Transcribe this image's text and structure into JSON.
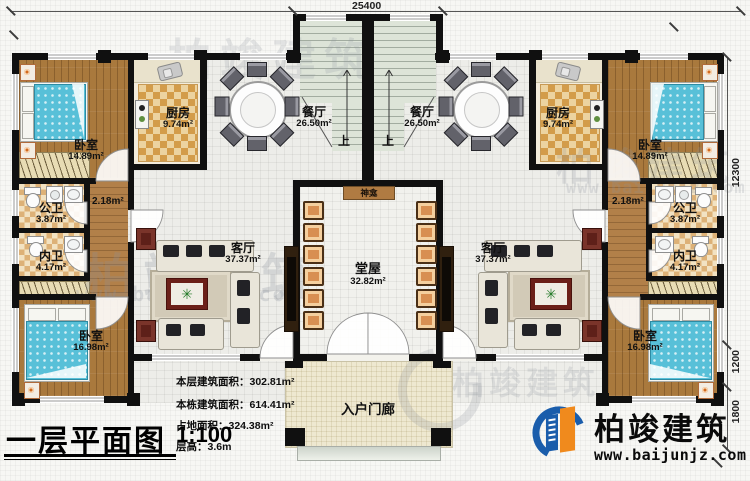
{
  "dimensions": {
    "top": "25400",
    "right_main": "12300",
    "right_mid": "1200",
    "right_low": "1800"
  },
  "rooms": {
    "bedroom_top": {
      "name": "卧室",
      "area": "14.89m²"
    },
    "kitchen": {
      "name": "厨房",
      "area": "9.74m²"
    },
    "dining": {
      "name": "餐厅",
      "area": "26.50m²"
    },
    "bath_public": {
      "name": "公卫",
      "area": "3.87m²"
    },
    "bath_private": {
      "name": "内卫",
      "area": "4.17m²"
    },
    "living": {
      "name": "客厅",
      "area": "37.37m²"
    },
    "bedroom_bottom": {
      "name": "卧室",
      "area": "16.98m²"
    },
    "hall": {
      "name": "堂屋",
      "area": "32.82m²"
    },
    "shrine": {
      "name": "神龛"
    },
    "porch": {
      "name": "入户门廊"
    },
    "corridor": {
      "area": "2.18m²"
    }
  },
  "labels": {
    "stairs_up": "上"
  },
  "titleblock": {
    "title": "一层平面图",
    "scale": "1:100"
  },
  "stats": [
    {
      "label": "本层建筑面积：",
      "value": "302.81m²"
    },
    {
      "label": "本栋建筑面积：",
      "value": "614.41m²"
    },
    {
      "label": "占地面积：",
      "value": "324.38m²"
    },
    {
      "label": "层高：",
      "value": "3.6m"
    }
  ],
  "logo": {
    "brand": "柏竣建筑",
    "website": "www.baijunjz.com"
  },
  "watermark": {
    "brand": "柏竣建筑",
    "site": "www.baijunjz.com"
  }
}
